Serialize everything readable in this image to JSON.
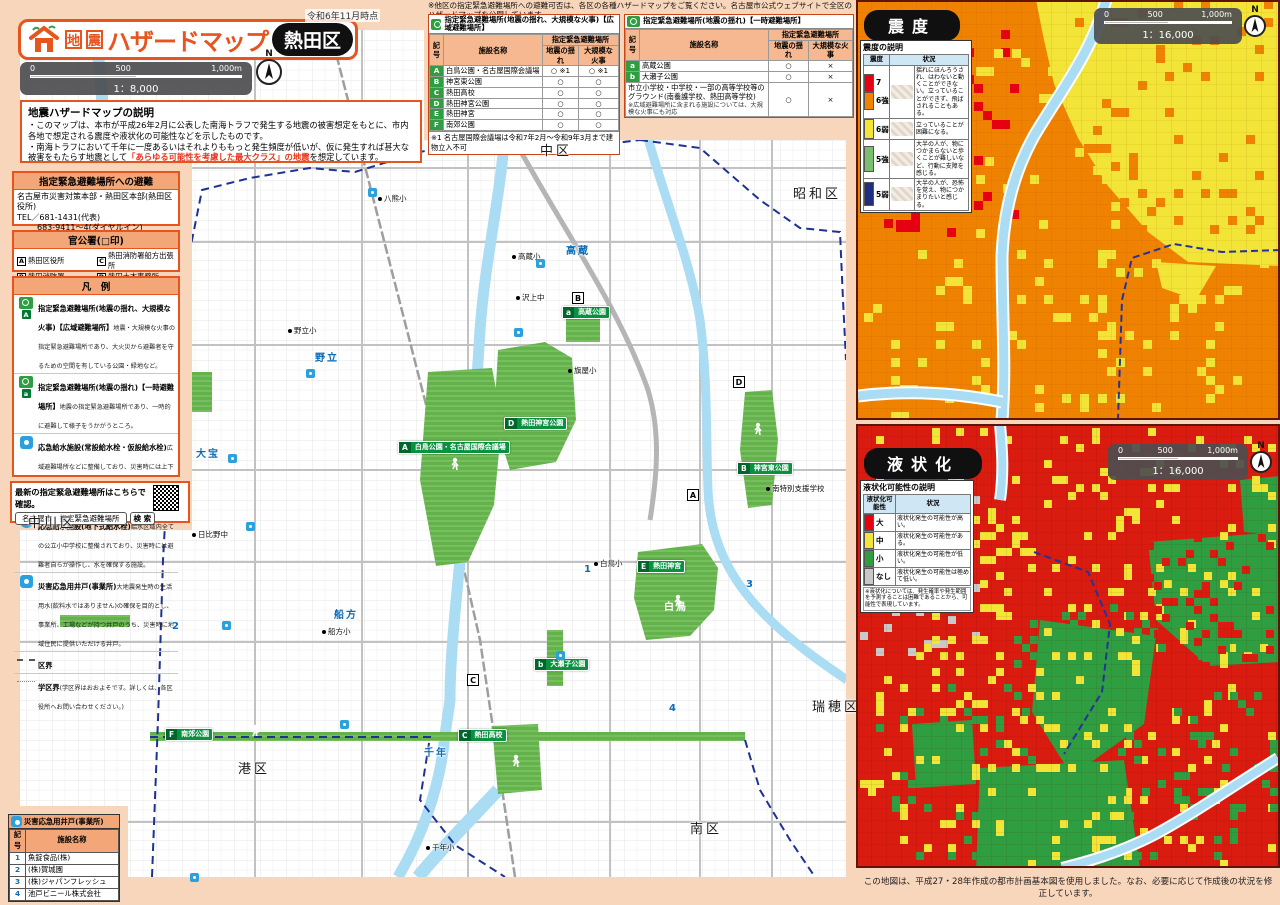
{
  "meta": {
    "date_note": "令和6年11月時点",
    "compass": "N"
  },
  "title": {
    "hazard_type": "地震",
    "main": "ハザードマップ",
    "ward": "熱田区"
  },
  "scale_main": {
    "t0": "0",
    "t1": "500",
    "t2": "1,000m",
    "ratio": "1：8,000"
  },
  "scale_sub": {
    "t0": "0",
    "t1": "500",
    "t2": "1,000m",
    "ratio": "1：16,000"
  },
  "description": {
    "heading": "地震ハザードマップの説明",
    "line1": "・このマップは、本市が平成26年2月に公表した南海トラフで発生する地震の被害想定をもとに、市内各地で想定される震度や液状化の可能性などを示したものです。",
    "line2_pre": "・南海トラフにおいて千年に一度あるいはそれよりももっと発生頻度が低いが、仮に発生すれば甚大な被害をもたらす地震として",
    "line2_em": "「あらゆる可能性を考慮した最大クラス」の地震",
    "line2_post": "を想定しています。"
  },
  "contact": {
    "heading": "指定緊急避難場所への避難",
    "org": "名古屋市災害対策本部・熱田区本部(熱田区役所)",
    "tel": "TEL／681-1431(代表)",
    "tel2": "683-9411～4(ダイヤルイン)",
    "fax": "FAX／682-1496"
  },
  "offices": {
    "heading": "官公署(□印)",
    "items": [
      {
        "mark": "A",
        "label": "熱田区役所"
      },
      {
        "mark": "B",
        "label": "熱田消防署"
      },
      {
        "mark": "C",
        "label": "熱田消防署船方出張所"
      },
      {
        "mark": "D",
        "label": "熱田土木事務所"
      }
    ]
  },
  "legend": {
    "heading": "凡　例",
    "items": [
      {
        "badge": "A",
        "title": "指定緊急避難場所(地震の揺れ、大規模な火事)【広域避難場所】",
        "desc": "地震・大規模な火事の指定緊急避難場所であり、大火災から避難者を守るための空間を有している公園・緑地など。"
      },
      {
        "badge": "a",
        "title": "指定緊急避難場所(地震の揺れ)【一時避難場所】",
        "desc": "地震の指定緊急避難場所であり、一時的に避難して様子をうかがうところ。"
      },
      {
        "badge": "",
        "title": "応急給水施設(常設給水栓・仮設給水栓)",
        "desc": "広域避難場所などに整備しており、災害時には上下水道局職員や応急給水協定を締結している民間事業者が開設する施設。"
      },
      {
        "badge": "",
        "title": "応急給水施設(地下式給水栓)",
        "desc": "給水区域内全ての公立小中学校に整備されており、災害時には避難者自らが操作し、水を確保する施設。"
      },
      {
        "badge": "",
        "title": "災害応急用井戸(事業所)",
        "desc": "大地震発生時の生活用水(飲料水ではありません)の確保を目的とし、事業所、工場などが持つ井戸のうち、災害時に地域住民に提供いただける井戸。"
      },
      {
        "badge": "",
        "title": "区界",
        "desc": ""
      },
      {
        "badge": "",
        "title": "学区界",
        "desc": "(学区界はおおよそです。詳しくは、各区役所へお問い合わせください。)"
      }
    ]
  },
  "qr_box": {
    "lead": "最新の指定緊急避難場所はこちらで確認。",
    "search_label": "名古屋市　指定緊急避難場所",
    "button": "検 索"
  },
  "wells": {
    "heading": "災害応急用井戸(事業所)",
    "col_mark": "記号",
    "col_name": "施設名称",
    "rows": [
      {
        "no": "1",
        "name": "魚錠食品(株)"
      },
      {
        "no": "2",
        "name": "(株)賀城園"
      },
      {
        "no": "3",
        "name": "(株)ジャパンフレッシュ"
      },
      {
        "no": "4",
        "name": "池戸ビニール株式会社"
      }
    ]
  },
  "top_note": "※他区の指定緊急避難場所への避難可否は、各区の各種ハザードマップをご覧ください。名古屋市公式ウェブサイトで全区のハザードマップを公開しています。",
  "table_wide": {
    "heading": "指定緊急避難場所(地震の揺れ、大規模な火事)【広域避難場所】",
    "col_mark": "記号",
    "col_name": "施設名称",
    "col_group": "指定緊急避難場所",
    "col_quake": "地震の揺れ",
    "col_fire": "大規模な火事",
    "rows": [
      {
        "mark": "A",
        "name": "白鳥公園・名古屋国際会議場",
        "quake": "○ ※1",
        "fire": "○ ※1"
      },
      {
        "mark": "B",
        "name": "神宮東公園",
        "quake": "○",
        "fire": "○"
      },
      {
        "mark": "C",
        "name": "熱田高校",
        "quake": "○",
        "fire": "○"
      },
      {
        "mark": "D",
        "name": "熱田神宮公園",
        "quake": "○",
        "fire": "○"
      },
      {
        "mark": "E",
        "name": "熱田神宮",
        "quake": "○",
        "fire": "○"
      },
      {
        "mark": "F",
        "name": "南郊公園",
        "quake": "○",
        "fire": "○"
      }
    ],
    "footnote": "※1 名古屋国際会議場は令和7年2月～令和9年3月まで建物立入不可"
  },
  "table_temp": {
    "heading": "指定緊急避難場所(地震の揺れ)【一時避難場所】",
    "col_mark": "記号",
    "col_name": "施設名称",
    "col_group": "指定緊急避難場所",
    "col_quake": "地震の揺れ",
    "col_fire": "大規模な火事",
    "rows": [
      {
        "mark": "a",
        "name": "高蔵公園",
        "quake": "○",
        "fire": "×"
      },
      {
        "mark": "b",
        "name": "大瀬子公園",
        "quake": "○",
        "fire": "×"
      }
    ],
    "special": {
      "name": "市立小学校・中学校・一部の高等学校等のグラウンド(南養護学校、熱田高等学校)",
      "note": "※広域避難場所に含まれる施設については、大規模な火事にも対応",
      "quake": "○",
      "fire": "×"
    }
  },
  "shindo": {
    "title": "震度",
    "legend_title": "震度の説明",
    "col_level": "震度",
    "col_desc": "状況",
    "levels": [
      {
        "label": "7",
        "color": "#e60012"
      },
      {
        "label": "6強",
        "color": "#f08300"
      },
      {
        "label": "6弱",
        "color": "#f2e537"
      },
      {
        "label": "5強",
        "color": "#7abf6e"
      },
      {
        "label": "5弱",
        "color": "#1e2f7d"
      }
    ],
    "descs": [
      "揺れにほんろうされ、はわないと動くことができない。立っていることができず、飛ばされることもある。",
      "立っていることが困難になる。",
      "大半の人が、物につかまらないと歩くことが難しいなど、行動に支障を感じる。",
      "大半の人が、恐怖を覚え、物につかまりたいと感じる。"
    ]
  },
  "ekijoka": {
    "title": "液状化",
    "legend_title": "液状化可能性の説明",
    "col_level": "液状化可能性",
    "col_desc": "状況",
    "rows": [
      {
        "label": "大",
        "color": "#e60012",
        "desc": "液状化発生の可能性が高い。"
      },
      {
        "label": "中",
        "color": "#f2e537",
        "desc": "液状化発生の可能性がある。"
      },
      {
        "label": "小",
        "color": "#2f9e41",
        "desc": "液状化発生の可能性が低い。"
      },
      {
        "label": "なし",
        "color": "#c8c8c9",
        "desc": "液状化発生の可能性は極めて低い。"
      }
    ],
    "footnote": "※液状化については、発生確率や発生範囲を予測することは困難であることから、可能性で表現しています。"
  },
  "bottom_note": "この地図は、平成27・28年作成の都市計画基本図を使用しました。なお、必要に応じて作成後の状況を修正しています。",
  "map": {
    "wards": [
      "中区",
      "昭和区",
      "瑞穂区",
      "南区",
      "港区",
      "中川区"
    ],
    "areas": [
      "高蔵",
      "野立",
      "大宝",
      "船方",
      "千年",
      "白鳥"
    ],
    "schools": [
      "八熊小",
      "高蔵小",
      "沢上中",
      "野立小",
      "旗屋小",
      "日比野中",
      "白鳥小",
      "船方小",
      "千年小",
      "南特別支援学校"
    ],
    "parks": [
      {
        "mark": "A",
        "name": "白鳥公園・名古屋国際会議場"
      },
      {
        "mark": "D",
        "name": "熱田神宮公園"
      },
      {
        "mark": "B",
        "name": "神宮東公園"
      },
      {
        "mark": "E",
        "name": "熱田神宮"
      },
      {
        "mark": "a",
        "name": "高蔵公園"
      },
      {
        "mark": "b",
        "name": "大瀬子公園"
      },
      {
        "mark": "F",
        "name": "南郊公園"
      },
      {
        "mark": "C",
        "name": "熱田高校"
      }
    ],
    "office_marks": [
      "A",
      "B",
      "C",
      "D"
    ],
    "well_marks": [
      "1",
      "2",
      "3",
      "4"
    ]
  },
  "colors": {
    "accent": "#e8541d",
    "peach": "#f8d6bc",
    "park": "#63b24c",
    "river": "#aadcf4",
    "shindo_base": "#ef8200",
    "ekijoka_base": "#da1b10"
  }
}
